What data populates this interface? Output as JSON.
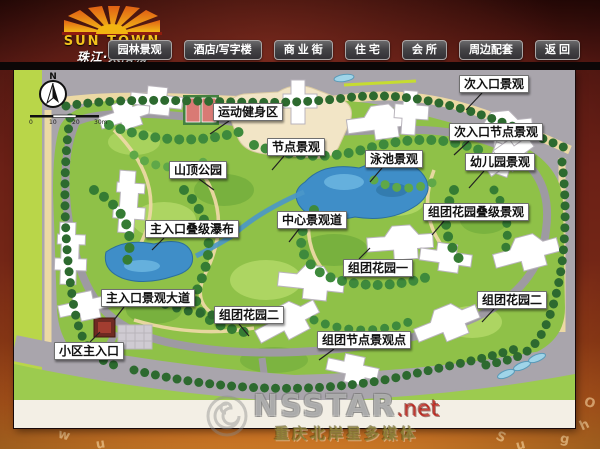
{
  "header": {
    "logo": {
      "line1": "SUN TOWN",
      "line2": "珠江·太阳城"
    },
    "nav": [
      {
        "label": "园林景观"
      },
      {
        "label": "酒店/写字楼"
      },
      {
        "label": "商 业 街"
      },
      {
        "label": "住 宅"
      },
      {
        "label": "会 所"
      },
      {
        "label": "周边配套"
      },
      {
        "label": "返 回"
      }
    ]
  },
  "map": {
    "compass_label": "N",
    "scale_ticks": [
      "0",
      "10",
      "20",
      "30m"
    ],
    "labels": [
      {
        "text": "运动健身区"
      },
      {
        "text": "节点景观"
      },
      {
        "text": "泳池景观"
      },
      {
        "text": "次入口景观"
      },
      {
        "text": "次入口节点景观"
      },
      {
        "text": "幼儿园景观"
      },
      {
        "text": "山顶公园"
      },
      {
        "text": "中心景观道"
      },
      {
        "text": "组团花园叠级景观"
      },
      {
        "text": "主入口叠级瀑布"
      },
      {
        "text": "组团花园一"
      },
      {
        "text": "组团花园二"
      },
      {
        "text": "主入口景观大道"
      },
      {
        "text": "组团花园二"
      },
      {
        "text": "组团节点景观点"
      },
      {
        "text": "小区主入口"
      }
    ]
  },
  "watermark": {
    "brand": "NSSTAR",
    "tld": ".net",
    "caption": "重庆北岸星多媒体"
  },
  "frame_letters": [
    "W",
    "w",
    "u",
    "S",
    "u",
    "g",
    "h",
    "O"
  ],
  "colors": {
    "frame_red": "#6b2016",
    "frame_orange": "#c96a20",
    "button_gray": "#454447",
    "map_green": "#8fc148",
    "water_blue": "#3f8ec8",
    "road_gray": "#a9a5ac",
    "logo_yellow": "#f2c21d"
  }
}
